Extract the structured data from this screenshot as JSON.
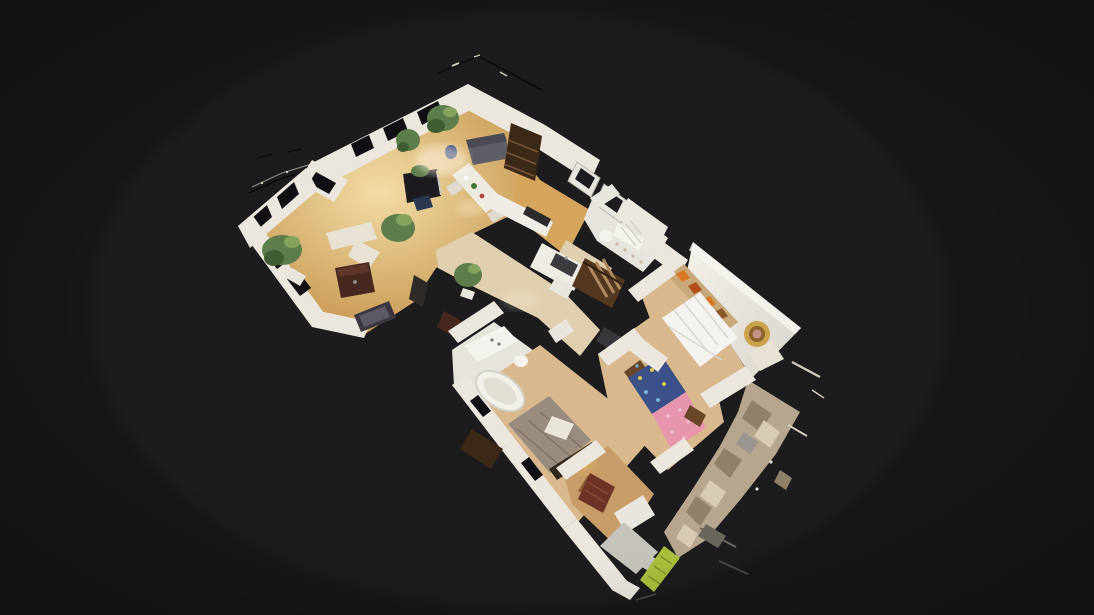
{
  "scene": {
    "app": "3d-virtual-tour-viewer",
    "view_mode": "dollhouse-cutaway",
    "subject": "apartment-3d-scan-floorplan",
    "background": "#17171a"
  },
  "rooms": [
    "living-room",
    "dining-area",
    "kitchen",
    "hallway",
    "corridor",
    "bathroom",
    "wc",
    "bedroom-master",
    "bedroom-kids",
    "bedroom-third",
    "entry-foyer",
    "balcony-terrace"
  ],
  "objects": [
    "gray-sofa",
    "blue-vase",
    "wood-bookcase",
    "piano",
    "piano-bench",
    "dining-table",
    "dining-chairs",
    "corner-sofa",
    "media-cabinet",
    "chaise",
    "potted-plants",
    "kitchen-counter",
    "stove-top",
    "kitchen-island-sink",
    "hall-mirror",
    "hall-cabinet",
    "hall-plant",
    "corridor-wardrobe",
    "corridor-mat",
    "radiator",
    "toilet",
    "bathtub",
    "bathroom-sink",
    "white-quilted-bed",
    "book-shelf-orange-books",
    "gold-round-mirror",
    "cream-bench",
    "kids-bed-blue-pink",
    "nightstand",
    "gray-bed",
    "bed-pillow",
    "woven-pouf",
    "bedside-lamp",
    "dark-wardrobe",
    "red-cabinet",
    "white-door",
    "cut-wall-tops",
    "scan-debris-fragments",
    "hedge-strip"
  ],
  "colors": {
    "bg": "#17171a",
    "wall": "#ebe7df",
    "wallShade": "#b9b4aa",
    "wallTopGray": "#c6c3bd",
    "windowHole": "#101014",
    "parquet": "#d6a55c",
    "parquetHi": "#f2dca6",
    "floorPale": "#e0cfae",
    "floorWood": "#d8b88c",
    "floorWarm": "#c89c66",
    "floorWhite": "#e7e4de",
    "slab": "#efece5",
    "slabShade": "#d9d5cc",
    "counter": "#eeece4",
    "stove": "#2b2b2e",
    "sink": "#3c3c40",
    "sofaGray": "#5e5e66",
    "sofaGrayDk": "#4a4a52",
    "sofaCream": "#e7e2d4",
    "tableDark": "#46281e",
    "tableDarkHi": "#5f352a",
    "chaise": "#3a3740",
    "chaiseHi": "#5c5964",
    "piano": "#1d1b20",
    "bench": "#2c3850",
    "bookcase": "#3c2817",
    "bookcaseHi": "#7a5638",
    "wardrobe": "#53381f",
    "clothes": "#b08a5f",
    "diningTop": "#edebe1",
    "chair": "#dedacf",
    "vase": "#2a3c72",
    "plant": "#5d7d4a",
    "plantDk": "#3f5c33",
    "plantLt": "#86a35e",
    "pot": "#e8e5dd",
    "tub": "#f2f0ea",
    "tubInner": "#e2ded4",
    "bath": "#e6e3dc",
    "fixture": "#f4f2ec",
    "ribLine": "#d0ccc2",
    "mirrorFrame": "#2e2a28",
    "mat": "#38383c",
    "shelfWood": "#c8a878",
    "orange1": "#d87820",
    "orange2": "#b05018",
    "bedWhite": "#f4f3ef",
    "quilt": "#d9d6cf",
    "gold": "#caa24c",
    "goldDk": "#8a6428",
    "goldCtr": "#c39388",
    "bedBlue": "#3c518a",
    "dotYellow": "#d8c84a",
    "dotLtBlue": "#74b4d8",
    "bedPink": "#e795ad",
    "bedPinkLt": "#f2c3d2",
    "bedGray": "#998b7d",
    "bedGrayDk": "#6f6257",
    "pillow": "#e9e5d9",
    "bedFrame": "#32281e",
    "pouf": "#8a5c32",
    "poufDk": "#5c3a1c",
    "nightstand": "#6a4628",
    "lamp": "#f0c96a",
    "lampCore": "#fce3a0",
    "cabinetRed": "#6e3226",
    "cabinetRedHi": "#8a4a36",
    "doorWhite": "#e9e6e0",
    "terrace": "#b7a68e",
    "terraceDk": "#8f8068",
    "terraceLt": "#d8cbb4",
    "green": "#a9bf3c",
    "debris": "#0b0b0d",
    "glint": "#d2cabb",
    "grayFrag": "#6a665e",
    "grayFrag2": "#4a4742",
    "edgeLight": "#8a857c",
    "highlight": "#fff6e6"
  }
}
